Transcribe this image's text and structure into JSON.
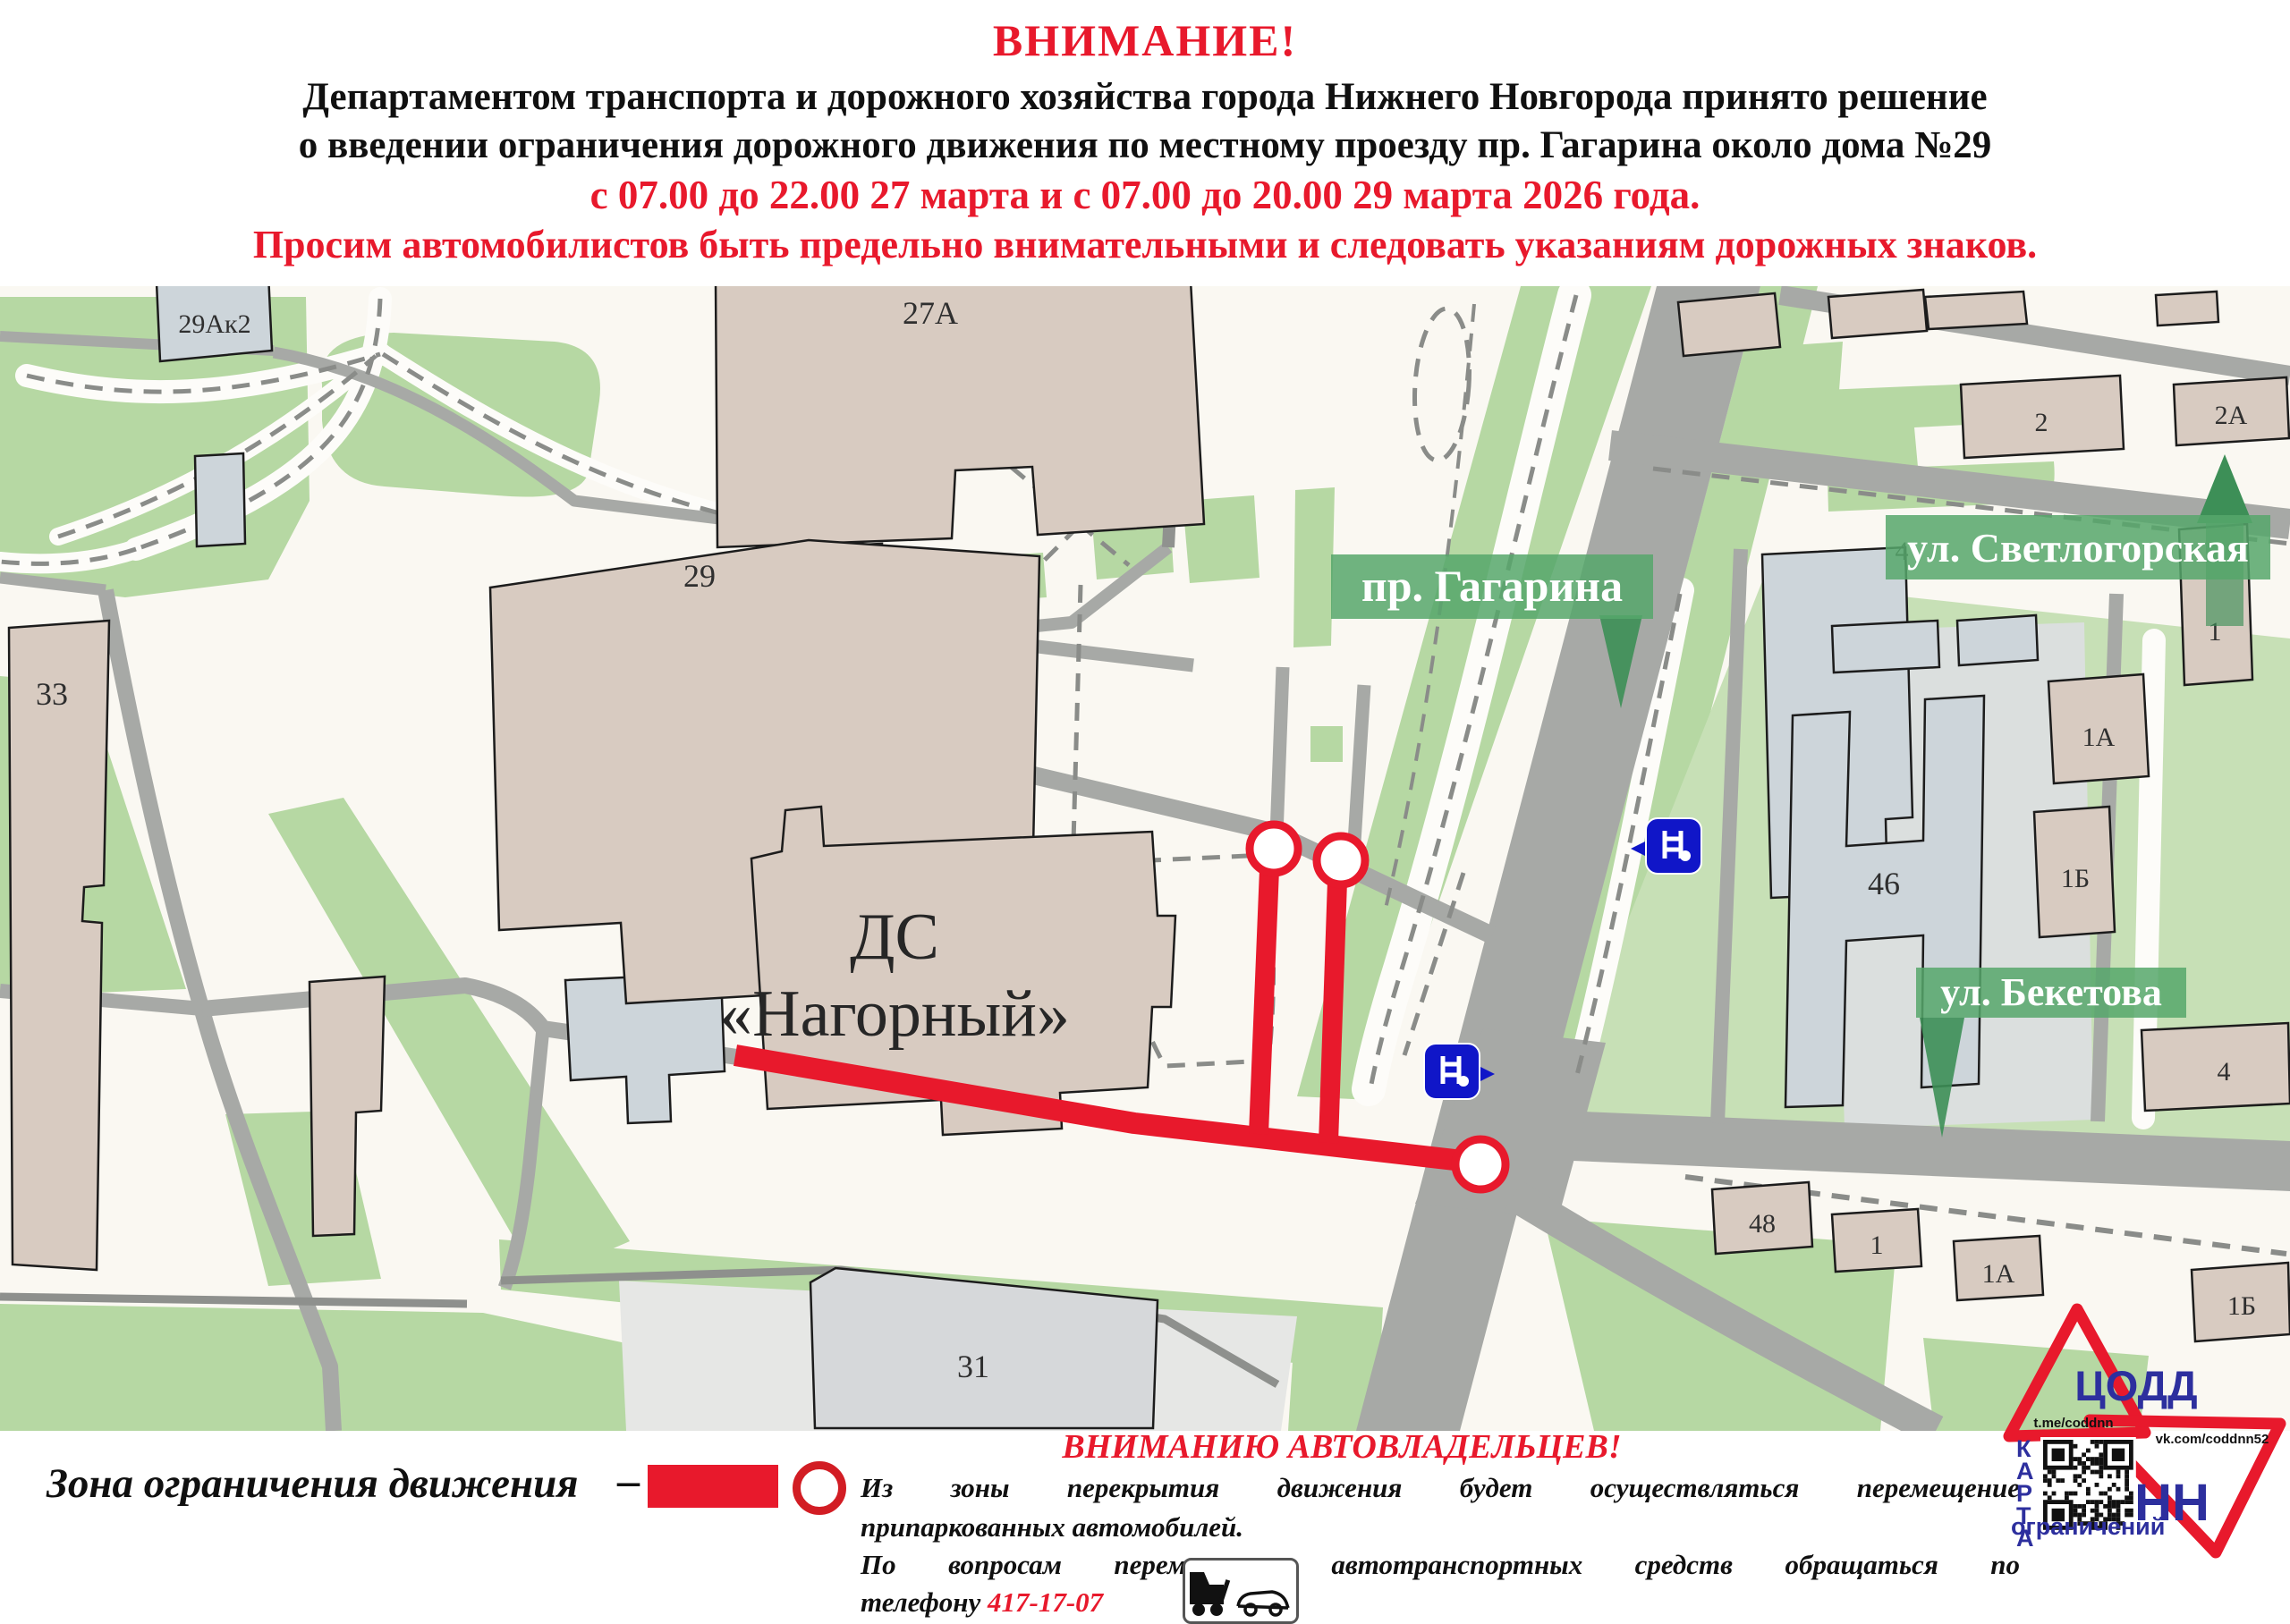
{
  "header": {
    "title": "ВНИМАНИЕ!",
    "line1": "Департаментом транспорта и дорожного хозяйства города Нижнего Новгорода принято решение",
    "line2": "о введении ограничения дорожного движения по местному проезду пр. Гагарина около дома №29",
    "dates_line": "с 07.00 до 22.00 27 марта и с 07.00 до 20.00 29 марта 2026 года.",
    "caution_line": "Просим автомобилистов быть предельно внимательными и следовать указаниям дорожных знаков."
  },
  "map": {
    "streets": {
      "gagarina": "пр. Гагарина",
      "svetlogorskaya": "ул. Светлогорская",
      "beketova": "ул. Бекетова"
    },
    "venue": {
      "line1": "ДС",
      "line2": "«Нагорный»"
    },
    "buildings": {
      "b29ak2": "29Ак2",
      "b27a": "27А",
      "b29": "29",
      "b33": "33",
      "b31": "31",
      "b2": "2",
      "b2a": "2А",
      "b1top": "1",
      "b4svet": "4",
      "b46": "46",
      "b1a_mid": "1А",
      "b1b_mid": "1Б",
      "b4right": "4",
      "b48": "48",
      "b1row": "1",
      "b1a_row": "1А",
      "b1b_row": "1Б"
    }
  },
  "legend": {
    "zone_label": "Зона ограничения движения",
    "dash": "–"
  },
  "notice": {
    "title": "ВНИМАНИЮ АВТОВЛАДЕЛЬЦЕВ!",
    "p1_line1": "Из зоны перекрытия движения будет осуществляться перемещение",
    "p1_line2": "припаркованных автомобилей.",
    "p2_line1": "По вопросам перемещения автотранспортных средств обращаться по",
    "p2_prefix": "телефону ",
    "phone": "417-17-07"
  },
  "logo": {
    "org": "ЦОДД",
    "region": "НН",
    "telegram": "t.me/coddnn",
    "vk": "vk.com/coddnn52",
    "karta_vertical": "КАРТА",
    "karta_bottom": "ограничений"
  },
  "colors": {
    "accent_red": "#e8192c",
    "banner_green": "#56a76b",
    "arrow_green": "#3d8f57",
    "logo_blue": "#2d2f9e",
    "bus_blue": "#1016c8",
    "map_green": "#b6d8a3",
    "road_gray": "#a7a9a6"
  }
}
